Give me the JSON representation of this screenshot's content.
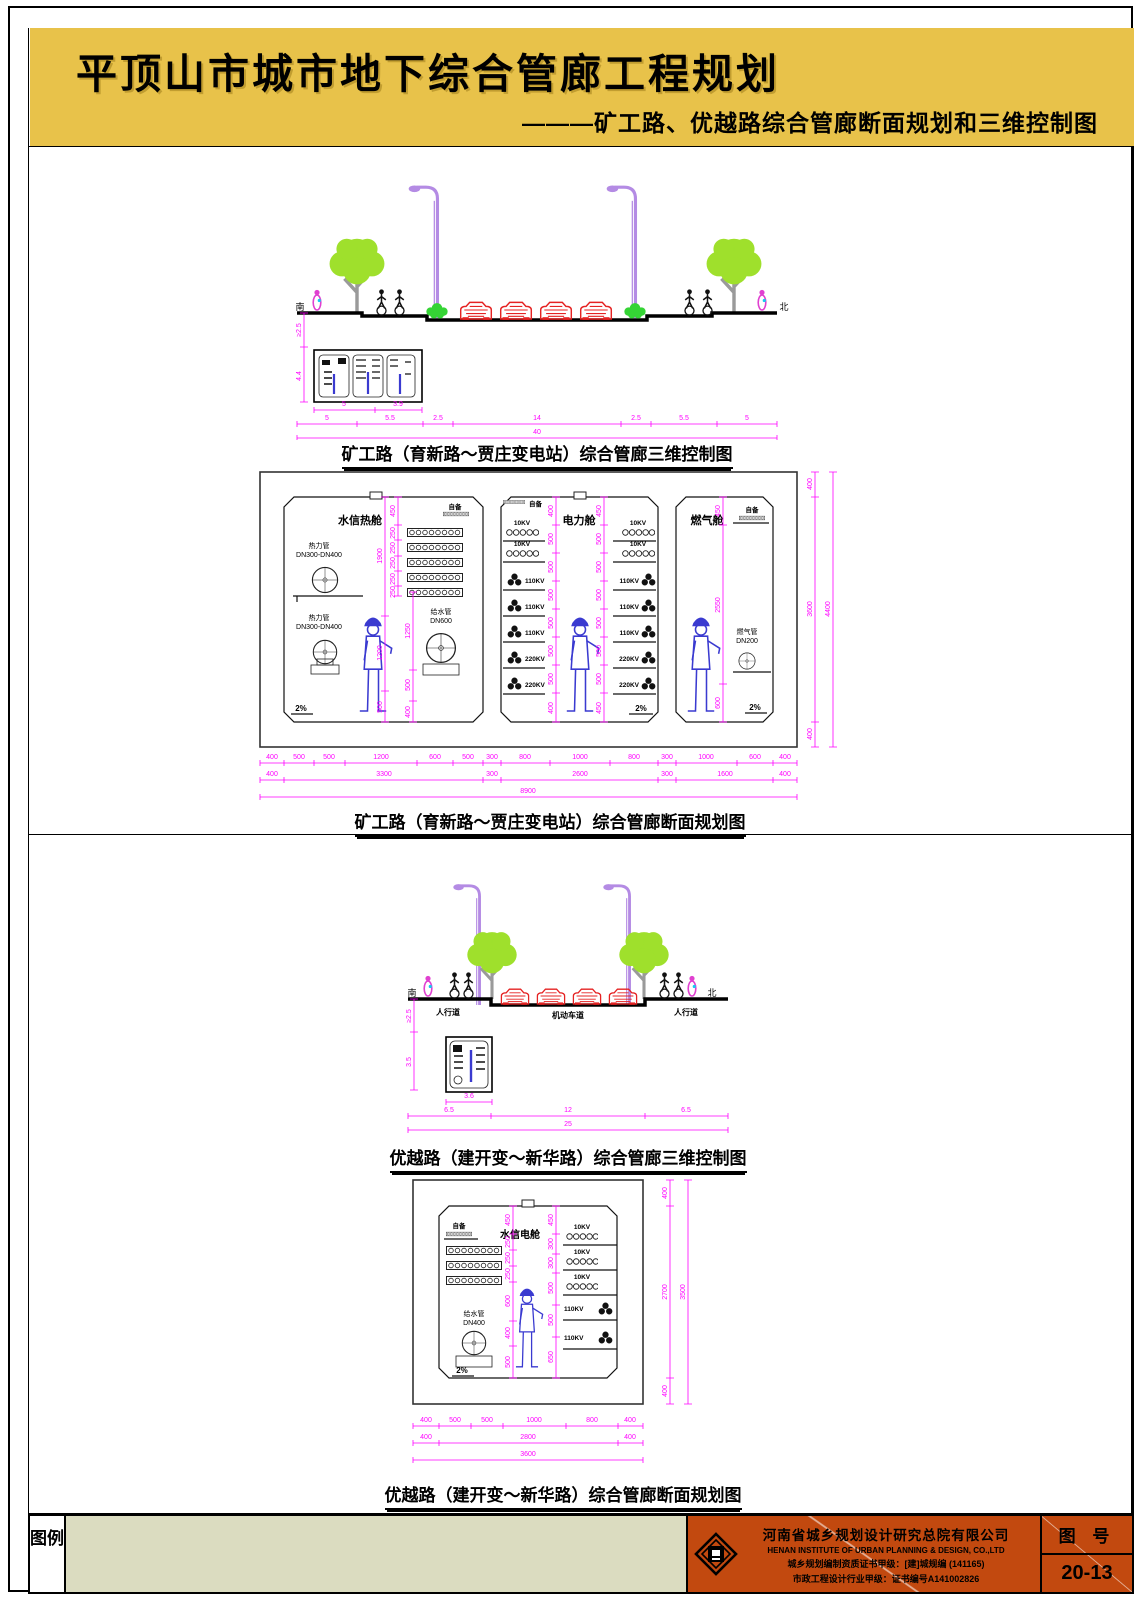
{
  "header": {
    "title": "平顶山市城市地下综合管廊工程规划",
    "subtitle": "———矿工路、优越路综合管廊断面规划和三维控制图"
  },
  "road1": {
    "south": "南",
    "north": "北",
    "dim_depth1": "≥2.5",
    "dim_depth2": "4.4",
    "box_dims": [
      "5",
      "3.9"
    ],
    "road_dims": [
      "5",
      "5.5",
      "2.5",
      "14",
      "2.5",
      "5.5",
      "5"
    ],
    "total": "40",
    "caption": "矿工路（育新路～贾庄变电站）综合管廊三维控制图"
  },
  "corridor1": {
    "caption": "矿工路（育新路～贾庄变电站）综合管廊断面规划图",
    "comp1": {
      "name": "水信热舱",
      "label_reserve": "自备",
      "pipe1_label": "热力管",
      "pipe1_size": "DN300-DN400",
      "pipe2_label": "热力管",
      "pipe2_size": "DN300-DN400",
      "pipe3_label": "给水管",
      "pipe3_size": "DN600",
      "slope": "2%",
      "tray_dims": [
        "450",
        "250",
        "250",
        "250",
        "250",
        "250"
      ],
      "left_dims": [
        "1900",
        "1200",
        "500"
      ],
      "right_dims": [
        "1250",
        "500",
        "400"
      ]
    },
    "comp2": {
      "name": "电力舱",
      "label_reserve": "自备",
      "slope": "2%",
      "cables_left": [
        "10KV",
        "10KV",
        "110KV",
        "110KV",
        "110KV",
        "220KV",
        "220KV"
      ],
      "cables_right": [
        "10KV",
        "10KV",
        "110KV",
        "110KV",
        "110KV",
        "220KV",
        "220KV"
      ],
      "dims_left": [
        "400",
        "500",
        "500",
        "500",
        "500",
        "500",
        "500",
        "400"
      ],
      "dims_right": [
        "450",
        "500",
        "500",
        "500",
        "500",
        "500",
        "500",
        "450"
      ]
    },
    "comp3": {
      "name": "燃气舱",
      "label_reserve": "自备",
      "pipe_label": "燃气管",
      "pipe_size": "DN200",
      "slope": "2%",
      "dims": [
        "450",
        "2550",
        "600"
      ]
    },
    "right_dims": [
      "400",
      "3600",
      "400"
    ],
    "right_total": "4400",
    "bottom_row1": [
      "400",
      "500",
      "500",
      "1200",
      "600",
      "500",
      "300",
      "800",
      "1000",
      "800",
      "300",
      "1000",
      "600",
      "400"
    ],
    "bottom_row2": [
      "400",
      "3300",
      "300",
      "2600",
      "300",
      "1600",
      "400"
    ],
    "bottom_total": "8900"
  },
  "road2": {
    "south": "南",
    "north": "北",
    "sidewalk_left": "人行道",
    "carriageway": "机动车道",
    "sidewalk_right": "人行道",
    "dim_depth1": "≥2.5",
    "dim_depth2": "3.5",
    "box_dim": "3.6",
    "road_dims": [
      "6.5",
      "12",
      "6.5"
    ],
    "total": "25",
    "caption": "优越路（建开变～新华路）综合管廊三维控制图"
  },
  "corridor2": {
    "caption": "优越路（建开变～新华路）综合管廊断面规划图",
    "name": "水信电舱",
    "label_reserve": "自备",
    "pipe_label": "给水管",
    "pipe_size": "DN400",
    "slope": "2%",
    "cables_right": [
      "10KV",
      "10KV",
      "10KV",
      "110KV",
      "110KV"
    ],
    "dims_left": [
      "450",
      "250",
      "250",
      "250",
      "600",
      "400",
      "500"
    ],
    "dims_right": [
      "450",
      "300",
      "300",
      "500",
      "500",
      "650"
    ],
    "outer_right": [
      "400",
      "2700",
      "400"
    ],
    "outer_total": "3500",
    "bottom_row1": [
      "400",
      "500",
      "500",
      "1000",
      "800",
      "400"
    ],
    "bottom_row2": [
      "400",
      "2800",
      "400"
    ],
    "bottom_total": "3600"
  },
  "footer": {
    "legend_label": "图例",
    "company_cn": "河南省城乡规划设计研究总院有限公司",
    "company_en": "HENAN INSTITUTE OF URBAN PLANNING & DESIGN, CO.,LTD",
    "cert1": "城乡规划编制资质证书甲级：[建]城规编 (141165)",
    "cert2": "市政工程设计行业甲级：证书编号A141002826",
    "sheet_label": "图 号",
    "sheet_number": "20-13"
  },
  "colors": {
    "gold": "#E8C24A",
    "rust": "#C2490F",
    "beige": "#DBDCC0",
    "magenta": "#FF00FF",
    "green": "#9FE02C",
    "purple": "#B48BE4",
    "red": "#E52222",
    "blue": "#3A3AD0",
    "pink": "#E040D0"
  }
}
